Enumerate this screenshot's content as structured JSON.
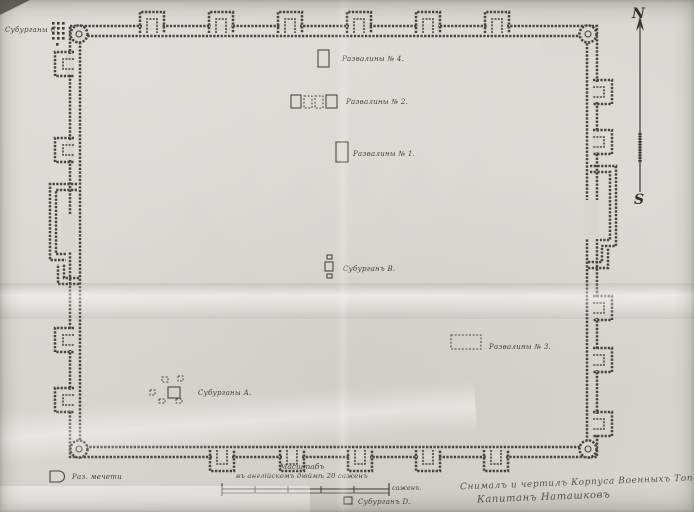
{
  "compass": {
    "north": "N",
    "south": "S"
  },
  "labels": {
    "suburgany_c": "Субурганы С.",
    "ruins_4": "Развалины № 4.",
    "ruins_2": "Развалины № 2.",
    "ruins_1": "Развалины № 1.",
    "suburgan_b": "Субурганъ В.",
    "ruins_3": "Развалины № 3.",
    "suburgany_a": "Субурганы А.",
    "suburgan_d": "Субурганъ D.",
    "legend_mosque": "Раз. мечети"
  },
  "scale": {
    "title": "Масштабъ",
    "subtitle": "въ англійскомъ дюймѣ 20 саженъ",
    "unit": "саженъ."
  },
  "signature": {
    "line1": "Снималъ и чертилъ Корпуса Военныхъ Топографовъ",
    "line2": "Капитанъ Наташковъ"
  },
  "colors": {
    "paper": "#d7d5d0",
    "ink": "#46443f"
  }
}
